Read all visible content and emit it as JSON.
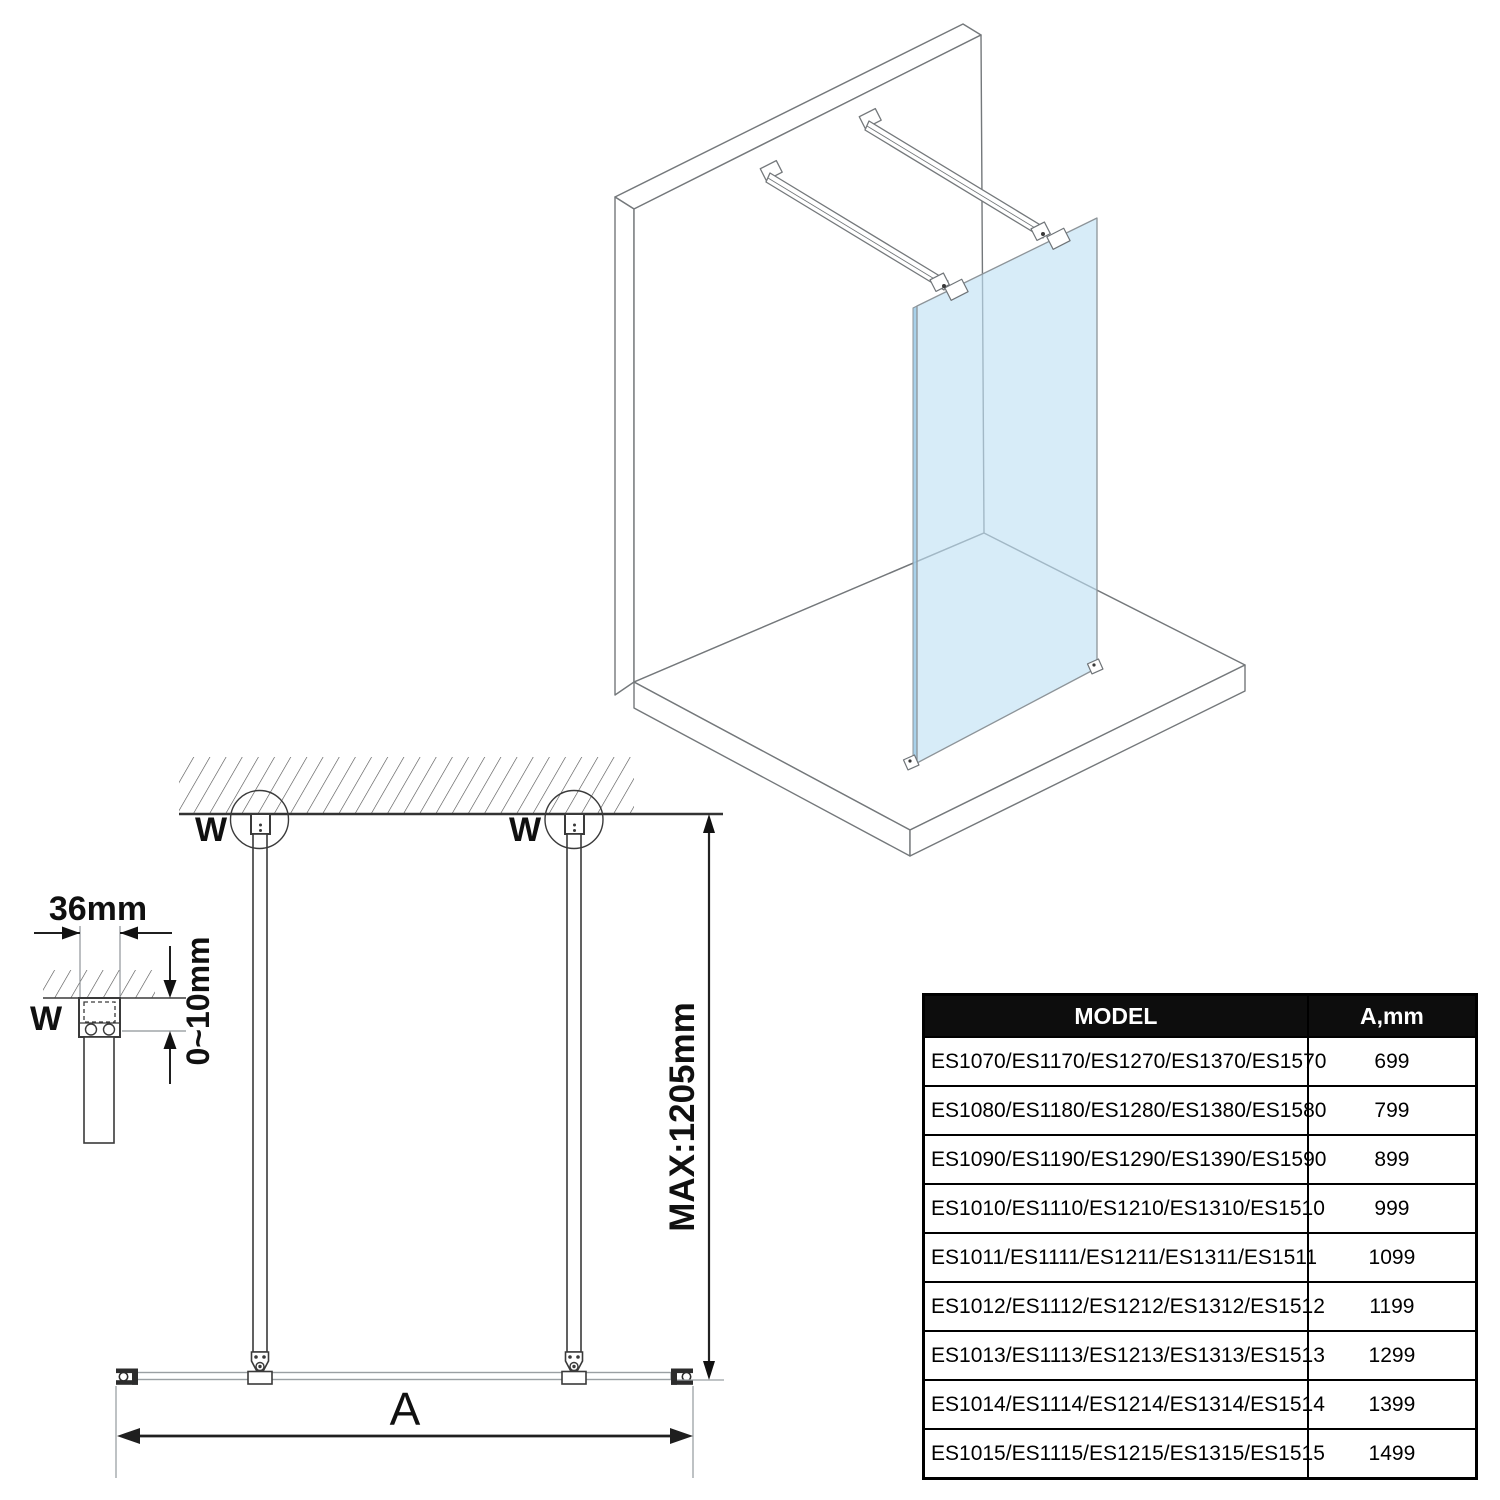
{
  "diagram": {
    "front_view": {
      "wall_marker_left": "W",
      "wall_marker_right": "W",
      "max_height_label": "MAX:1205mm",
      "width_dim_label": "A"
    },
    "detail_view": {
      "wall_marker": "W",
      "profile_width_label": "36mm",
      "adjust_range_label": "0~10mm"
    }
  },
  "table": {
    "headers": {
      "model": "MODEL",
      "width": "A,mm"
    },
    "rows": [
      {
        "model": "ES1070/ES1170/ES1270/ES1370/ES1570",
        "a_mm": "699"
      },
      {
        "model": "ES1080/ES1180/ES1280/ES1380/ES1580",
        "a_mm": "799"
      },
      {
        "model": "ES1090/ES1190/ES1290/ES1390/ES1590",
        "a_mm": "899"
      },
      {
        "model": "ES1010/ES1110/ES1210/ES1310/ES1510",
        "a_mm": "999"
      },
      {
        "model": "ES1011/ES1111/ES1211/ES1311/ES1511",
        "a_mm": "1099"
      },
      {
        "model": "ES1012/ES1112/ES1212/ES1312/ES1512",
        "a_mm": "1199"
      },
      {
        "model": "ES1013/ES1113/ES1213/ES1313/ES1513",
        "a_mm": "1299"
      },
      {
        "model": "ES1014/ES1114/ES1214/ES1314/ES1514",
        "a_mm": "1399"
      },
      {
        "model": "ES1015/ES1115/ES1215/ES1315/ES1515",
        "a_mm": "1499"
      }
    ]
  },
  "colors": {
    "glass_blue": "#bfe0f4",
    "glass_edge_blue": "#9fcce8",
    "table_header_bg": "#0d0d0d",
    "table_header_text": "#ffffff",
    "line_dark": "#3a3a3a",
    "line_iso": "#74787b"
  }
}
